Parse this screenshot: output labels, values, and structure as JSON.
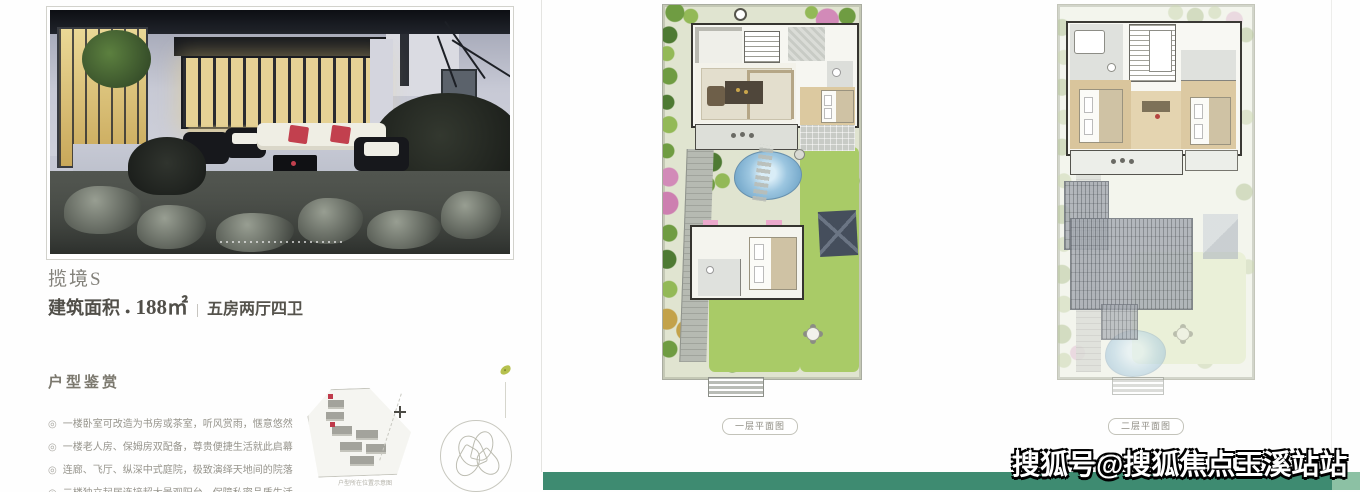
{
  "left": {
    "title": "揽境S",
    "area": {
      "label": "建筑面积",
      "bullet": "●",
      "value": "188㎡",
      "divider": "|",
      "rooms": "五房两厅四卫"
    },
    "section": {
      "heading": "户型鉴赏",
      "bullet_icon": "◎",
      "items": [
        "一楼卧室可改造为书房或茶室，听风赏雨，惬意悠然",
        "一楼老人房、保姆房双配备，尊贵便捷生活就此启幕",
        "连廊、飞厅、纵深中式庭院，极致演绎天地间的院落",
        "二楼独立起居连接超大景观阳台，保障私密品质生活"
      ]
    },
    "sitemap_caption": "户型所在位置示意图"
  },
  "plans": {
    "first_label": "一层平面图",
    "second_label": "二层平面图"
  },
  "watermark": "搜狐号@搜狐焦点玉溪站站",
  "colors": {
    "green_bar": "#3e8b71",
    "green_bar_light": "#8cc1a4",
    "accent_red": "#c2404e",
    "pillow_red": "#c2404e"
  }
}
